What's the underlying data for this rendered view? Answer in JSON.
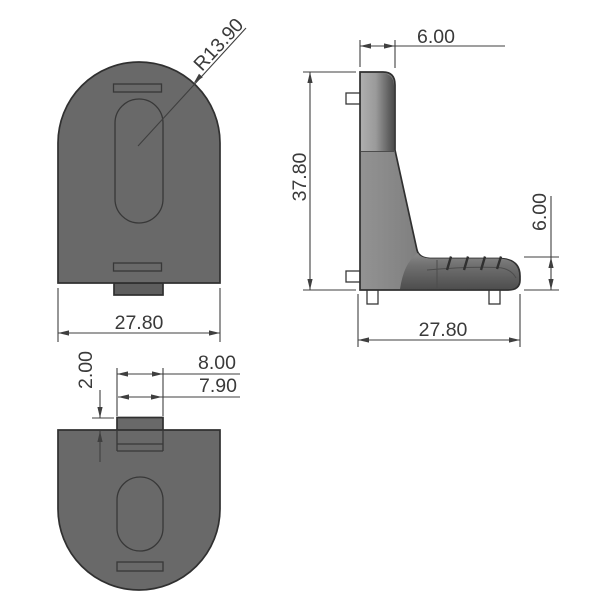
{
  "colors": {
    "background": "#ffffff",
    "body": "#696969",
    "body_shadow": "#5e5e5e",
    "tab_fill": "#6f6f6f",
    "outline": "#303030",
    "hole": "#ffffff",
    "dimension_line": "#3f3f3f",
    "dimension_text": "#3a3a3a",
    "highlight": "#aeaeae"
  },
  "views": {
    "front": {
      "width_label": "27.80",
      "radius_label": "R13.90"
    },
    "side": {
      "thickness_label": "6.00",
      "height_label": "37.80",
      "base_height_label": "6.00",
      "base_width_label": "27.80"
    },
    "bottom": {
      "step_label": "2.00",
      "outer_width_label": "8.00",
      "inner_width_label": "7.90"
    }
  }
}
